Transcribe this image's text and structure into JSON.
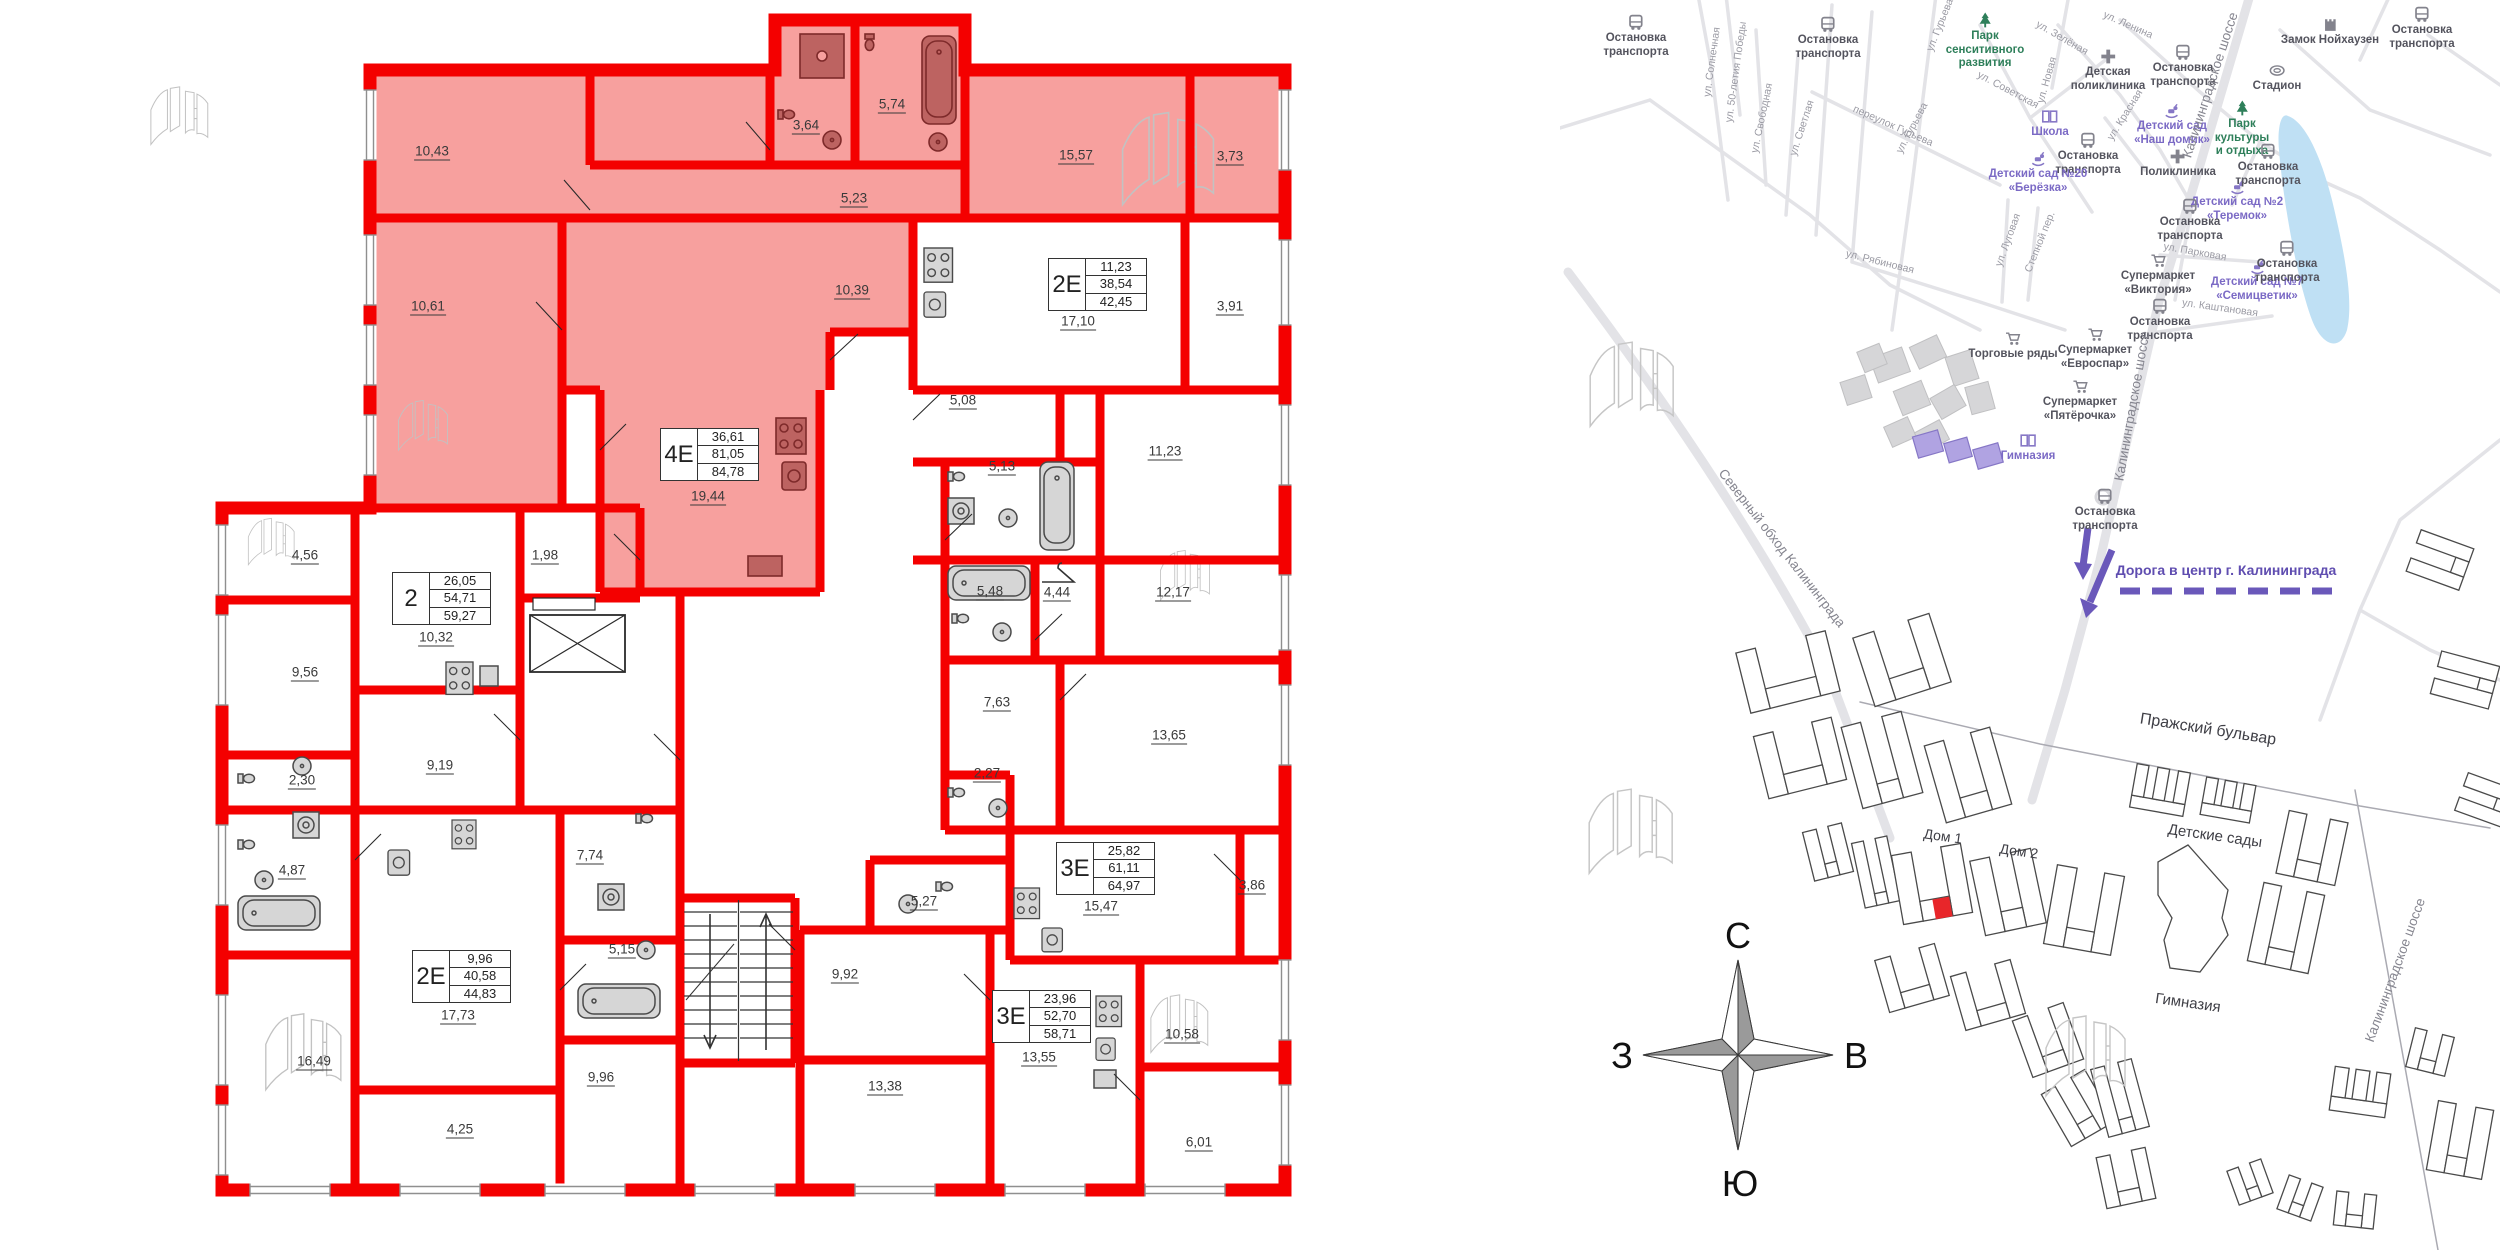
{
  "colors": {
    "wall_red": "#f40000",
    "apartment_pink": "#f7a09e",
    "fixture_dark": "#b85a58",
    "marker_red": "#e8262a",
    "pond_blue": "#bfe0f4",
    "map_green": "#2e7f5a",
    "map_purple": "#7b6ac5",
    "route_purple": "#6a58ba"
  },
  "floorplan": {
    "tables": [
      {
        "type": "4Е",
        "values": [
          "36,61",
          "81,05",
          "84,78"
        ],
        "x": 660,
        "y": 428
      },
      {
        "type": "2Е",
        "values": [
          "11,23",
          "38,54",
          "42,45"
        ],
        "x": 1048,
        "y": 258
      },
      {
        "type": "2",
        "values": [
          "26,05",
          "54,71",
          "59,27"
        ],
        "x": 392,
        "y": 572
      },
      {
        "type": "3Е",
        "values": [
          "25,82",
          "61,11",
          "64,97"
        ],
        "x": 1056,
        "y": 842
      },
      {
        "type": "2Е",
        "values": [
          "9,96",
          "40,58",
          "44,83"
        ],
        "x": 412,
        "y": 950
      },
      {
        "type": "3Е",
        "values": [
          "23,96",
          "52,70",
          "58,71"
        ],
        "x": 992,
        "y": 990
      }
    ],
    "room_labels": [
      {
        "t": "10,43",
        "x": 432,
        "y": 152
      },
      {
        "t": "3,64",
        "x": 806,
        "y": 126
      },
      {
        "t": "5,74",
        "x": 892,
        "y": 105
      },
      {
        "t": "5,23",
        "x": 854,
        "y": 199
      },
      {
        "t": "15,57",
        "x": 1076,
        "y": 156
      },
      {
        "t": "3,73",
        "x": 1230,
        "y": 157
      },
      {
        "t": "10,61",
        "x": 428,
        "y": 307
      },
      {
        "t": "10,39",
        "x": 852,
        "y": 291
      },
      {
        "t": "19,44",
        "x": 708,
        "y": 497
      },
      {
        "t": "17,10",
        "x": 1078,
        "y": 322
      },
      {
        "t": "3,91",
        "x": 1230,
        "y": 307
      },
      {
        "t": "5,08",
        "x": 963,
        "y": 401
      },
      {
        "t": "5,13",
        "x": 1002,
        "y": 467
      },
      {
        "t": "11,23",
        "x": 1165,
        "y": 452
      },
      {
        "t": "5,48",
        "x": 990,
        "y": 592
      },
      {
        "t": "4,44",
        "x": 1057,
        "y": 593
      },
      {
        "t": "12,17",
        "x": 1173,
        "y": 593
      },
      {
        "t": "7,63",
        "x": 997,
        "y": 703
      },
      {
        "t": "13,65",
        "x": 1169,
        "y": 736
      },
      {
        "t": "2,27",
        "x": 987,
        "y": 774
      },
      {
        "t": "15,47",
        "x": 1101,
        "y": 907
      },
      {
        "t": "3,86",
        "x": 1252,
        "y": 886
      },
      {
        "t": "5,27",
        "x": 924,
        "y": 902
      },
      {
        "t": "9,92",
        "x": 845,
        "y": 975
      },
      {
        "t": "13,38",
        "x": 885,
        "y": 1087
      },
      {
        "t": "13,55",
        "x": 1039,
        "y": 1058
      },
      {
        "t": "10,58",
        "x": 1182,
        "y": 1035
      },
      {
        "t": "6,01",
        "x": 1199,
        "y": 1143
      },
      {
        "t": "4,56",
        "x": 305,
        "y": 556
      },
      {
        "t": "1,98",
        "x": 545,
        "y": 556
      },
      {
        "t": "10,32",
        "x": 436,
        "y": 638
      },
      {
        "t": "9,56",
        "x": 305,
        "y": 673
      },
      {
        "t": "2,30",
        "x": 302,
        "y": 781
      },
      {
        "t": "9,19",
        "x": 440,
        "y": 766
      },
      {
        "t": "4,87",
        "x": 292,
        "y": 871
      },
      {
        "t": "16,49",
        "x": 314,
        "y": 1062
      },
      {
        "t": "17,73",
        "x": 458,
        "y": 1016
      },
      {
        "t": "4,25",
        "x": 460,
        "y": 1130
      },
      {
        "t": "7,74",
        "x": 590,
        "y": 856
      },
      {
        "t": "5,15",
        "x": 622,
        "y": 950
      },
      {
        "t": "9,96",
        "x": 601,
        "y": 1078
      }
    ]
  },
  "map": {
    "poi": [
      {
        "icon": "bus",
        "lines": [
          "Остановка",
          "транспорта"
        ],
        "x": 76,
        "y": 14
      },
      {
        "icon": "bus",
        "lines": [
          "Остановка",
          "транспорта"
        ],
        "x": 268,
        "y": 16
      },
      {
        "icon": "tree",
        "lines": [
          "Парк",
          "сенситивного",
          "развития"
        ],
        "x": 425,
        "y": 12,
        "c": "green"
      },
      {
        "icon": "bus",
        "lines": [
          "Остановка",
          "транспорта"
        ],
        "x": 623,
        "y": 44
      },
      {
        "icon": "cross",
        "lines": [
          "Детская",
          "поликлиника"
        ],
        "x": 548,
        "y": 48
      },
      {
        "icon": "castle",
        "lines": [
          "Замок Нойхаузен"
        ],
        "x": 770,
        "y": 16
      },
      {
        "icon": "bus",
        "lines": [
          "Остановка",
          "транспорта"
        ],
        "x": 862,
        "y": 6
      },
      {
        "icon": "stadium",
        "lines": [
          "Стадион"
        ],
        "x": 717,
        "y": 62
      },
      {
        "icon": "tree",
        "lines": [
          "Парк",
          "культуры",
          "и отдыха"
        ],
        "x": 682,
        "y": 100,
        "c": "green"
      },
      {
        "icon": "book",
        "lines": [
          "Школа"
        ],
        "x": 490,
        "y": 108,
        "c": "purple"
      },
      {
        "icon": "bus",
        "lines": [
          "Остановка",
          "транспорта"
        ],
        "x": 528,
        "y": 132
      },
      {
        "icon": "horse",
        "lines": [
          "Детский сад",
          "«Наш домик»"
        ],
        "x": 612,
        "y": 102,
        "c": "purple"
      },
      {
        "icon": "horse",
        "lines": [
          "Детский сад №20",
          "«Берёзка»"
        ],
        "x": 478,
        "y": 150,
        "c": "purple"
      },
      {
        "icon": "horse",
        "lines": [
          "Детский сад №2",
          "«Теремок»"
        ],
        "x": 677,
        "y": 178,
        "c": "purple"
      },
      {
        "icon": "cross",
        "lines": [
          "Поликлиника"
        ],
        "x": 618,
        "y": 148
      },
      {
        "icon": "bus",
        "lines": [
          "Остановка",
          "транспорта"
        ],
        "x": 630,
        "y": 198
      },
      {
        "icon": "bus",
        "lines": [
          "Остановка",
          "транспорта"
        ],
        "x": 708,
        "y": 143
      },
      {
        "icon": "cart",
        "lines": [
          "Супермаркет",
          "«Виктория»"
        ],
        "x": 598,
        "y": 252
      },
      {
        "icon": "horse",
        "lines": [
          "Детский сад №7",
          "«Семицветик»"
        ],
        "x": 697,
        "y": 258,
        "c": "purple"
      },
      {
        "icon": "bus",
        "lines": [
          "Остановка",
          "транспорта"
        ],
        "x": 727,
        "y": 240
      },
      {
        "icon": "bus",
        "lines": [
          "Остановка",
          "транспорта"
        ],
        "x": 600,
        "y": 298
      },
      {
        "icon": "cart",
        "lines": [
          "Торговые ряды"
        ],
        "x": 453,
        "y": 330
      },
      {
        "icon": "cart",
        "lines": [
          "Супермаркет",
          "«Евроспар»"
        ],
        "x": 535,
        "y": 326
      },
      {
        "icon": "cart",
        "lines": [
          "Супермаркет",
          "«Пятёрочка»"
        ],
        "x": 520,
        "y": 378
      },
      {
        "icon": "book",
        "lines": [
          "Гимназия"
        ],
        "x": 468,
        "y": 432,
        "c": "purple"
      },
      {
        "icon": "bus",
        "lines": [
          "Остановка",
          "транспорта"
        ],
        "x": 545,
        "y": 488
      }
    ],
    "streets": [
      {
        "t": "ул. Солнечная",
        "x": 152,
        "y": 62,
        "r": -82
      },
      {
        "t": "ул. 50-летия Победы",
        "x": 176,
        "y": 72,
        "r": -82
      },
      {
        "t": "ул. Свободная",
        "x": 202,
        "y": 118,
        "r": -78
      },
      {
        "t": "ул. Светлая",
        "x": 242,
        "y": 128,
        "r": -72
      },
      {
        "t": "переулок Гурьева",
        "x": 333,
        "y": 126,
        "r": 24
      },
      {
        "t": "ул. Гурьева",
        "x": 380,
        "y": 25,
        "r": -68
      },
      {
        "t": "ул. Гурьева",
        "x": 352,
        "y": 128,
        "r": -62
      },
      {
        "t": "ул. Советская",
        "x": 448,
        "y": 90,
        "r": 28
      },
      {
        "t": "ул. Рябиновая",
        "x": 320,
        "y": 262,
        "r": 14
      },
      {
        "t": "ул. Луговая",
        "x": 448,
        "y": 240,
        "r": -70
      },
      {
        "t": "ул. Ленина",
        "x": 568,
        "y": 25,
        "r": 24
      },
      {
        "t": "ул. Зелёная",
        "x": 502,
        "y": 38,
        "r": 30
      },
      {
        "t": "ул. Новая",
        "x": 487,
        "y": 80,
        "r": -74
      },
      {
        "t": "ул. Красная",
        "x": 565,
        "y": 115,
        "r": -58
      },
      {
        "t": "ул. Парковая",
        "x": 635,
        "y": 252,
        "r": 10
      },
      {
        "t": "ул. Каштановая",
        "x": 660,
        "y": 308,
        "r": 8
      },
      {
        "t": "Степной пер.",
        "x": 480,
        "y": 242,
        "r": -68
      },
      {
        "t": "Калининградское шоссе",
        "x": 650,
        "y": 85,
        "r": -72,
        "big": true
      },
      {
        "t": "Калининградское шоссе",
        "x": 572,
        "y": 406,
        "r": -80,
        "big": true
      },
      {
        "t": "Калининградское шоссе",
        "x": 835,
        "y": 970,
        "r": -70,
        "big": true
      },
      {
        "t": "Северный обход Калининграда",
        "x": 222,
        "y": 548,
        "r": 52,
        "big": true
      }
    ],
    "places": [
      {
        "t": "Пражский бульвар",
        "x": 648,
        "y": 730,
        "r": 9,
        "s": 16
      },
      {
        "t": "Детские сады",
        "x": 655,
        "y": 836,
        "r": 8,
        "s": 15
      },
      {
        "t": "Гимназия",
        "x": 628,
        "y": 1003,
        "r": 8,
        "s": 15
      },
      {
        "t": "Дом 1",
        "x": 383,
        "y": 836,
        "r": 8,
        "s": 14
      },
      {
        "t": "Дом 2",
        "x": 459,
        "y": 851,
        "r": 8,
        "s": 14
      }
    ],
    "route_label": {
      "text": "Дорога в центр г. Калининграда",
      "x": 666,
      "y": 570
    },
    "compass": {
      "n": "С",
      "e": "В",
      "s": "Ю",
      "w": "З"
    }
  }
}
